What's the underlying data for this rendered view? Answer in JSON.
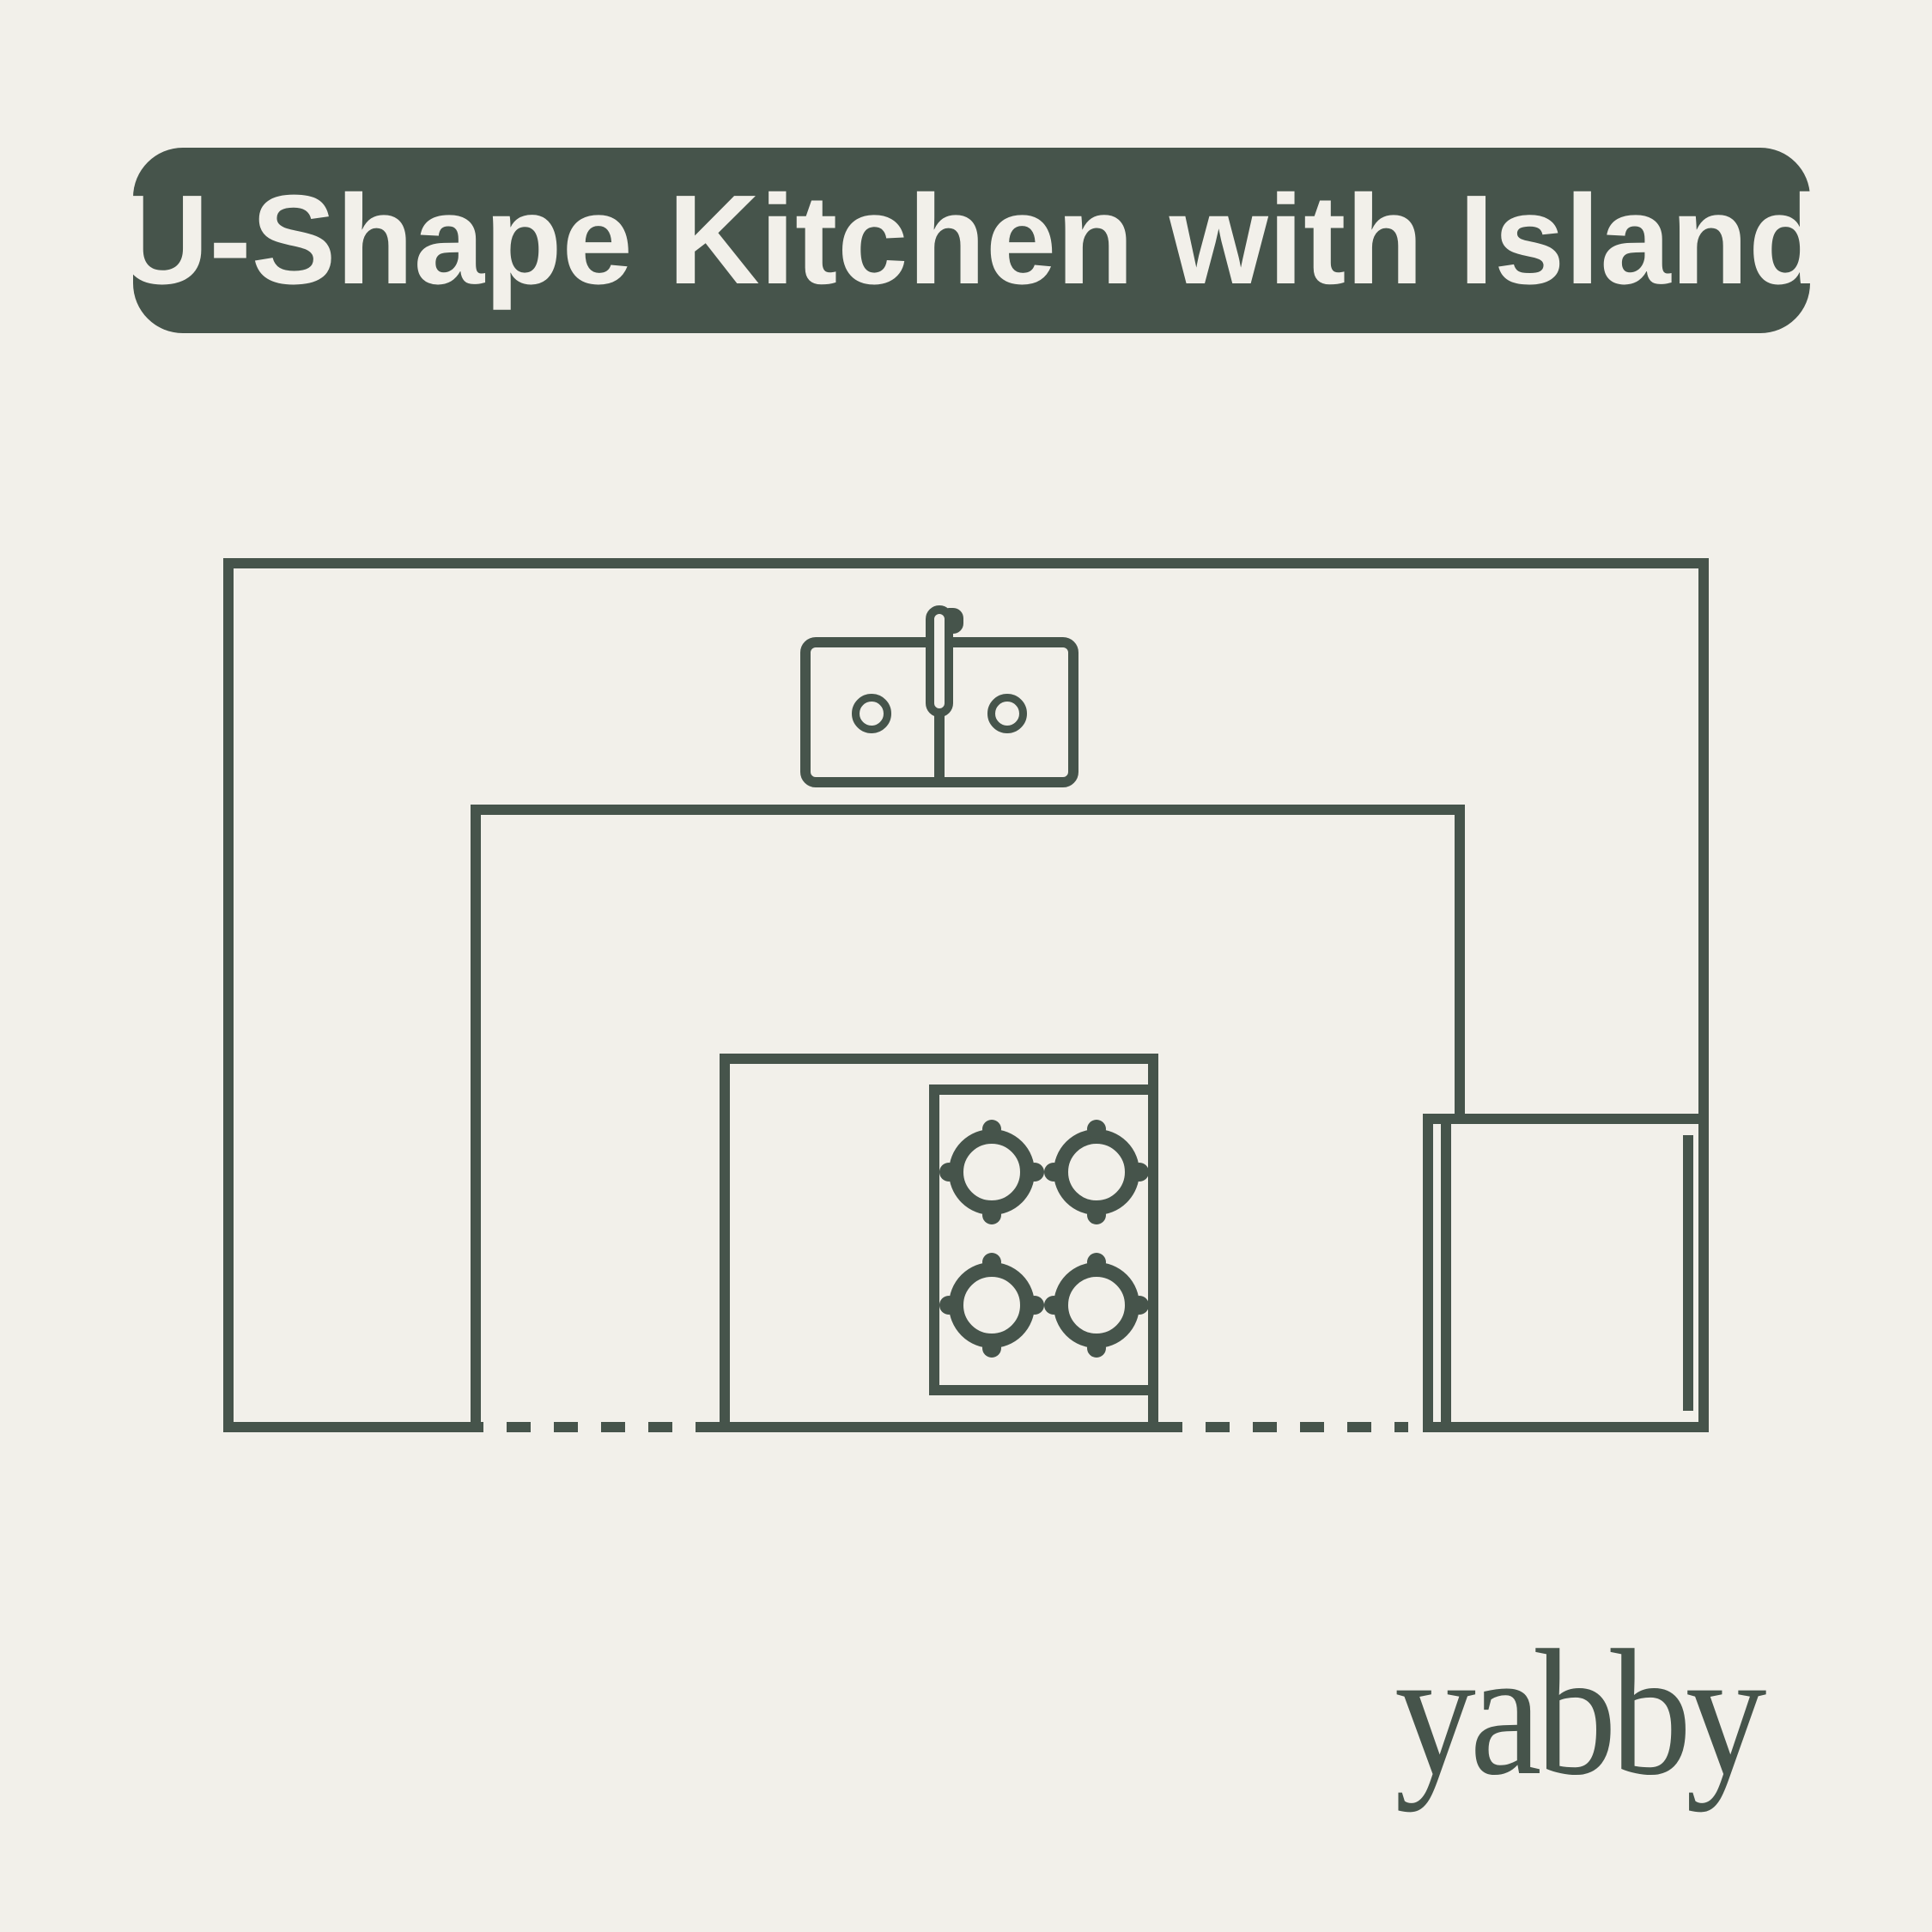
{
  "colors": {
    "background": "#F2F0EA",
    "ink": "#46544B",
    "banner_background": "#46544B",
    "banner_text": "#F2F0EA"
  },
  "banner": {
    "title": "U-Shape Kitchen with Island"
  },
  "diagram": {
    "type": "kitchen-floor-plan",
    "layout": "U-shape counter with center island",
    "components": [
      "u-shaped-counter",
      "double-basin-sink",
      "faucet",
      "kitchen-island",
      "four-burner-cooktop",
      "refrigerator",
      "dashed-floor-opening"
    ],
    "cooktop_burners": 4,
    "sink_basins": 2
  },
  "footer": {
    "logo": "yabby"
  }
}
